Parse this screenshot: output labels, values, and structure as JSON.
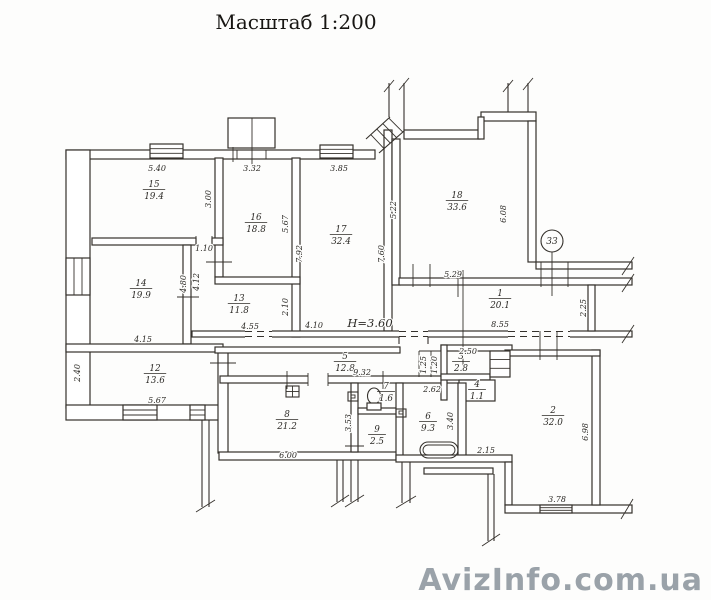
{
  "title": "Масштаб 1:200",
  "watermark": "AvizInfo.com.ua",
  "colors": {
    "ink": "#35312c",
    "paper": "#fdfdfc",
    "watermark": "#9aa2a9"
  },
  "drawing": {
    "rooms": [
      {
        "number": "15",
        "area": "19.4",
        "x": 154,
        "y": 187
      },
      {
        "number": "16",
        "area": "18.8",
        "x": 256,
        "y": 220
      },
      {
        "number": "17",
        "area": "32.4",
        "x": 341,
        "y": 232
      },
      {
        "number": "18",
        "area": "33.6",
        "x": 457,
        "y": 198
      },
      {
        "number": "14",
        "area": "19.9",
        "x": 141,
        "y": 286
      },
      {
        "number": "13",
        "area": "11.8",
        "x": 239,
        "y": 301
      },
      {
        "number": "12",
        "area": "13.6",
        "x": 155,
        "y": 371
      },
      {
        "number": "1",
        "area": "20.1",
        "x": 500,
        "y": 296
      },
      {
        "number": "5",
        "area": "12.8",
        "x": 345,
        "y": 359
      },
      {
        "number": "3",
        "area": "2.8",
        "x": 461,
        "y": 359
      },
      {
        "number": "4",
        "area": "1.1",
        "x": 477,
        "y": 387
      },
      {
        "number": "7",
        "area": "1.6",
        "x": 386,
        "y": 389
      },
      {
        "number": "9",
        "area": "2.5",
        "x": 377,
        "y": 432
      },
      {
        "number": "6",
        "area": "9.3",
        "x": 428,
        "y": 419
      },
      {
        "number": "8",
        "area": "21.2",
        "x": 287,
        "y": 417
      },
      {
        "number": "2",
        "area": "32.0",
        "x": 553,
        "y": 413
      }
    ],
    "dimensions": [
      {
        "text": "5.40",
        "x": 157,
        "y": 171,
        "rot": 0
      },
      {
        "text": "3.32",
        "x": 252,
        "y": 171,
        "rot": 0
      },
      {
        "text": "3.85",
        "x": 339,
        "y": 171,
        "rot": 0
      },
      {
        "text": "3.00",
        "x": 211,
        "y": 199,
        "rot": -90
      },
      {
        "text": "5.67",
        "x": 288,
        "y": 224,
        "rot": -90
      },
      {
        "text": "5.22",
        "x": 396,
        "y": 210,
        "rot": -90
      },
      {
        "text": "6.08",
        "x": 506,
        "y": 214,
        "rot": -90
      },
      {
        "text": "7.92",
        "x": 302,
        "y": 254,
        "rot": -90
      },
      {
        "text": "7.60",
        "x": 384,
        "y": 254,
        "rot": -90
      },
      {
        "text": "1.10",
        "x": 204,
        "y": 251,
        "rot": 0
      },
      {
        "text": "4.80",
        "x": 186,
        "y": 284,
        "rot": -90
      },
      {
        "text": "4.12",
        "x": 199,
        "y": 282,
        "rot": -90
      },
      {
        "text": "2.10",
        "x": 288,
        "y": 307,
        "rot": -90
      },
      {
        "text": "5.29",
        "x": 453,
        "y": 277,
        "rot": 0
      },
      {
        "text": "8.55",
        "x": 500,
        "y": 327,
        "rot": 0
      },
      {
        "text": "2.25",
        "x": 586,
        "y": 308,
        "rot": -90
      },
      {
        "text": "4.15",
        "x": 143,
        "y": 342,
        "rot": 0
      },
      {
        "text": "4.55",
        "x": 250,
        "y": 329,
        "rot": 0
      },
      {
        "text": "4.10",
        "x": 314,
        "y": 328,
        "rot": 0
      },
      {
        "text": "9.32",
        "x": 362,
        "y": 375,
        "rot": 0
      },
      {
        "text": "2.40",
        "x": 80,
        "y": 373,
        "rot": -90
      },
      {
        "text": "5.67",
        "x": 157,
        "y": 403,
        "rot": 0
      },
      {
        "text": "2.50",
        "x": 468,
        "y": 354,
        "rot": 0
      },
      {
        "text": "1.25",
        "x": 426,
        "y": 365,
        "rot": -90
      },
      {
        "text": "1.20",
        "x": 437,
        "y": 365,
        "rot": -90
      },
      {
        "text": "2.62",
        "x": 432,
        "y": 392,
        "rot": 0
      },
      {
        "text": "3.40",
        "x": 453,
        "y": 421,
        "rot": -90
      },
      {
        "text": "3.53",
        "x": 351,
        "y": 423,
        "rot": -90
      },
      {
        "text": "6.00",
        "x": 288,
        "y": 458,
        "rot": 0
      },
      {
        "text": "2.15",
        "x": 486,
        "y": 453,
        "rot": 0
      },
      {
        "text": "6.98",
        "x": 588,
        "y": 432,
        "rot": -90
      },
      {
        "text": "3.78",
        "x": 557,
        "y": 502,
        "rot": 0
      }
    ],
    "annotations": [
      {
        "text": "Н=3.60",
        "x": 370,
        "y": 327
      }
    ],
    "markers": [
      {
        "text": "33",
        "x": 552,
        "y": 241
      }
    ]
  }
}
